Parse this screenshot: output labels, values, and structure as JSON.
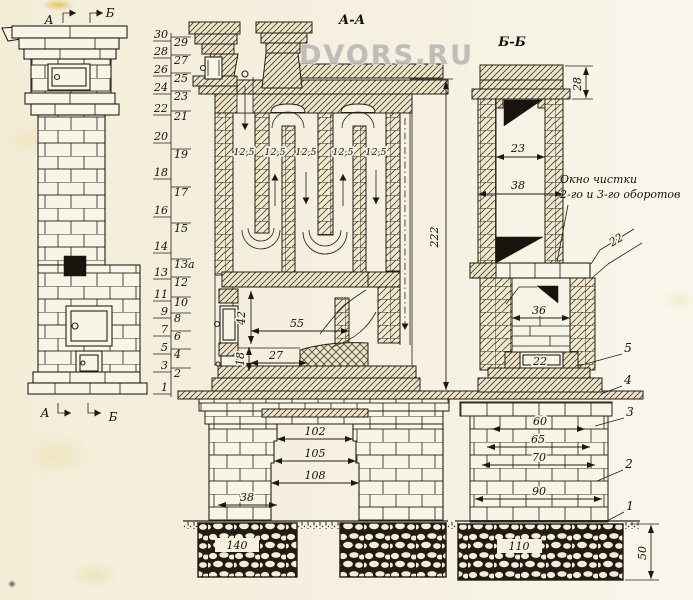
{
  "watermark": "DVORS.RU",
  "colors": {
    "paper": "#f5f0e0",
    "ink": "#242019",
    "hatch_fill": "#f0e9ce",
    "dark": "#17140e",
    "watermark_gray": "#b7b5b1"
  },
  "front_view": {
    "top_a": "А",
    "top_b": "Б",
    "bottom_a": "А",
    "bottom_b": "Б"
  },
  "rows": {
    "left": [
      "30",
      "28",
      "26",
      "24",
      "22",
      "20",
      "18",
      "16",
      "14",
      "13",
      "11",
      "9",
      "7",
      "5",
      "3",
      "1"
    ],
    "right": [
      "29",
      "27",
      "25",
      "23",
      "21",
      "19",
      "17",
      "15",
      "13а",
      "12",
      "10",
      "8",
      "6",
      "4",
      "2"
    ]
  },
  "aa": {
    "title": "А-А",
    "ch": [
      "12,5",
      "12,5",
      "12,5",
      "12,5",
      "12,5"
    ],
    "d42": "42",
    "d55": "55",
    "d27": "27",
    "d18": "18",
    "d222": "222",
    "f102": "102",
    "f105": "105",
    "f108": "108",
    "f38": "38",
    "f140": "140"
  },
  "bb": {
    "title": "Б-Б",
    "d28": "28",
    "d23": "23",
    "d38": "38",
    "note1": "Окно чистки",
    "note2": "2-го и 3-го оборотов",
    "d22_ledge": "22",
    "d36": "36",
    "d22_door": "22",
    "c5": "5",
    "c4": "4",
    "c3": "3",
    "c2": "2",
    "c1": "1",
    "f60": "60",
    "f65": "65",
    "f70": "70",
    "f90": "90",
    "f110": "110",
    "d50": "50"
  }
}
